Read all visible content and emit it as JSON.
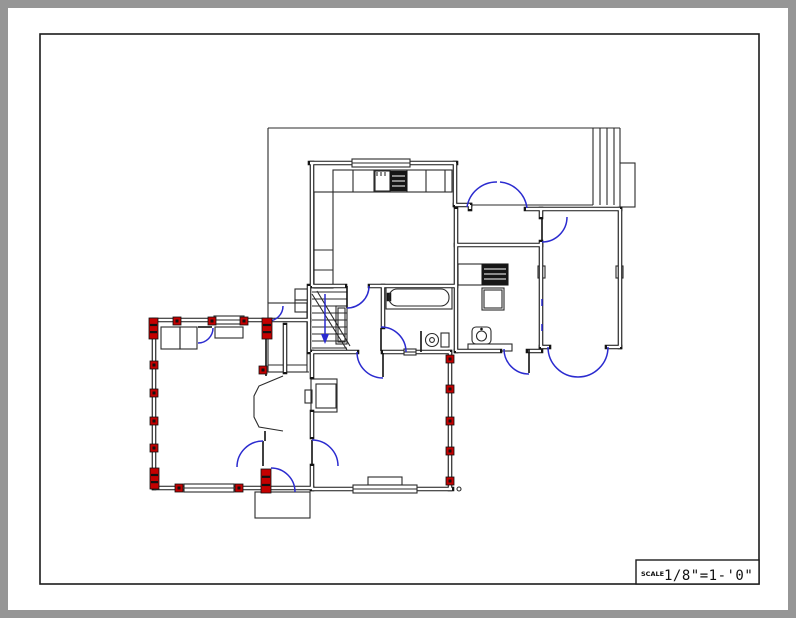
{
  "page": {
    "bg": "#969696",
    "paper": "#ffffff"
  },
  "colors": {
    "ink": "#2b2b2b",
    "blue": "#2b2bcf",
    "red": "#c40000",
    "wall": "#151515"
  },
  "scale_box": {
    "label": "SCALE",
    "value": "1/8\"=1-'0\""
  },
  "plan": {
    "thin_rects": [
      [
        268,
        303,
        39,
        69
      ],
      [
        255,
        492,
        55,
        26
      ],
      [
        620,
        163,
        15,
        44
      ],
      [
        333,
        170,
        119,
        22
      ],
      [
        314,
        192,
        19,
        96
      ],
      [
        374,
        171,
        16,
        20
      ],
      [
        458,
        264,
        50,
        21
      ],
      [
        482,
        288,
        22,
        22
      ],
      [
        484,
        290,
        18,
        18
      ],
      [
        386,
        286,
        66,
        23
      ],
      [
        441,
        333,
        8,
        14
      ],
      [
        468,
        344,
        44,
        7
      ],
      [
        311,
        379,
        26,
        33
      ],
      [
        316,
        384,
        20,
        24
      ],
      [
        305,
        390,
        7,
        13
      ],
      [
        336,
        306,
        11,
        38
      ],
      [
        338,
        308,
        7,
        34
      ],
      [
        161,
        327,
        19,
        22
      ],
      [
        180,
        327,
        17,
        22
      ],
      [
        215,
        327,
        28,
        11
      ],
      [
        295,
        289,
        13,
        11
      ],
      [
        295,
        300,
        13,
        12
      ],
      [
        368,
        477,
        34,
        8
      ],
      [
        538,
        266,
        7,
        12
      ],
      [
        616,
        266,
        7,
        12
      ]
    ],
    "thin_lines": [
      [
        268,
        128,
        620,
        128
      ],
      [
        268,
        128,
        268,
        303
      ],
      [
        458,
        205,
        593,
        205
      ],
      [
        593,
        128,
        593,
        205
      ],
      [
        600,
        128,
        600,
        205
      ],
      [
        607,
        128,
        607,
        205
      ],
      [
        614,
        128,
        614,
        205
      ],
      [
        620,
        128,
        620,
        163
      ],
      [
        268,
        365,
        307,
        365
      ],
      [
        285,
        372,
        309,
        372
      ],
      [
        353,
        170,
        353,
        192
      ],
      [
        375,
        170,
        375,
        192
      ],
      [
        407,
        170,
        407,
        192
      ],
      [
        426,
        170,
        426,
        192
      ],
      [
        445,
        170,
        445,
        192
      ],
      [
        314,
        250,
        333,
        250
      ],
      [
        314,
        270,
        333,
        270
      ],
      [
        482,
        264,
        482,
        285
      ],
      [
        312,
        292,
        347,
        292
      ],
      [
        312,
        299,
        347,
        299
      ],
      [
        312,
        306,
        347,
        306
      ],
      [
        312,
        313,
        347,
        313
      ],
      [
        312,
        320,
        347,
        320
      ],
      [
        312,
        327,
        347,
        327
      ],
      [
        312,
        334,
        347,
        334
      ],
      [
        312,
        341,
        347,
        341
      ],
      [
        312,
        348,
        347,
        348
      ],
      [
        312,
        294,
        347,
        350
      ],
      [
        317,
        291,
        350,
        346
      ],
      [
        377,
        172,
        377,
        176
      ],
      [
        381,
        172,
        381,
        176
      ],
      [
        385,
        172,
        385,
        176
      ]
    ],
    "hollow_walls": [
      [
        310,
        163,
        353,
        163
      ],
      [
        410,
        163,
        456,
        163
      ],
      [
        312,
        163,
        312,
        286
      ],
      [
        455,
        163,
        455,
        205
      ],
      [
        455,
        205,
        470,
        205
      ],
      [
        470,
        205,
        470,
        209
      ],
      [
        526,
        209,
        620,
        209
      ],
      [
        541,
        209,
        541,
        217
      ],
      [
        541,
        242,
        541,
        347
      ],
      [
        620,
        209,
        620,
        347
      ],
      [
        541,
        347,
        549,
        347
      ],
      [
        607,
        347,
        620,
        347
      ],
      [
        456,
        209,
        456,
        351
      ],
      [
        456,
        245,
        541,
        245
      ],
      [
        456,
        351,
        500,
        351
      ],
      [
        528,
        351,
        541,
        351
      ],
      [
        312,
        286,
        345,
        286
      ],
      [
        370,
        286,
        456,
        286
      ],
      [
        309,
        286,
        309,
        352
      ],
      [
        383,
        286,
        383,
        327
      ],
      [
        312,
        352,
        357,
        352
      ],
      [
        383,
        352,
        404,
        352
      ],
      [
        416,
        352,
        450,
        352
      ],
      [
        450,
        352,
        450,
        489
      ],
      [
        312,
        489,
        353,
        489
      ],
      [
        417,
        489,
        452,
        489
      ],
      [
        312,
        352,
        312,
        377
      ],
      [
        312,
        412,
        312,
        437
      ],
      [
        312,
        466,
        312,
        489
      ],
      [
        152,
        320,
        262,
        320
      ],
      [
        154,
        320,
        154,
        488
      ],
      [
        154,
        488,
        262,
        488
      ],
      [
        271,
        320,
        309,
        320
      ],
      [
        271,
        488,
        312,
        488
      ],
      [
        285,
        325,
        285,
        372
      ]
    ],
    "windows": [
      [
        352,
        159,
        58,
        8
      ],
      [
        353,
        485,
        64,
        8
      ],
      [
        214,
        316,
        30,
        8
      ],
      [
        184,
        484,
        50,
        8
      ],
      [
        404,
        349,
        12,
        6
      ]
    ],
    "dark_rects": [
      [
        390,
        171,
        17,
        20
      ],
      [
        482,
        264,
        26,
        21
      ],
      [
        387,
        293,
        4,
        8
      ]
    ],
    "white_lines": [
      [
        392,
        176,
        405,
        176
      ],
      [
        392,
        181,
        405,
        181
      ],
      [
        392,
        186,
        405,
        186
      ],
      [
        484,
        269,
        506,
        269
      ],
      [
        484,
        274,
        506,
        274
      ],
      [
        484,
        279,
        506,
        279
      ]
    ],
    "round_rects": [
      [
        389,
        289,
        60,
        17,
        8
      ],
      [
        472,
        327,
        19,
        17,
        4
      ]
    ],
    "circles": [
      [
        432,
        340,
        6.5
      ],
      [
        432,
        340,
        2.4
      ],
      [
        481.5,
        336,
        5
      ],
      [
        459,
        489,
        2
      ]
    ],
    "dots": [
      [
        481.5,
        329,
        1.3
      ]
    ],
    "leaf_lines": [
      [
        347,
        286,
        347,
        308
      ],
      [
        381,
        328,
        381,
        351
      ],
      [
        542,
        218,
        542,
        241
      ],
      [
        312,
        440,
        312,
        465
      ],
      [
        263,
        441,
        263,
        466
      ],
      [
        383,
        353,
        383,
        377
      ],
      [
        529,
        349,
        529,
        373
      ],
      [
        198,
        327,
        212,
        327
      ],
      [
        421,
        331,
        421,
        352
      ],
      [
        266,
        338,
        266,
        376
      ],
      [
        265,
        431,
        265,
        441
      ]
    ],
    "thin_paths": [
      "M 283,376 L 259,386 L 254,396 L 254,417 L 259,427 L 283,431"
    ],
    "blue_arcs": [
      "M 347,308 A 22 22 0 0 0 369,286",
      "M 467,207 A 30 30 0 0 1 497,182",
      "M 500,182 A 30 30 0 0 1 527,208",
      "M 542,242 A 25 25 0 0 0 567,217",
      "M 381,327 A 25 25 0 0 1 406,352",
      "M 357,352 A 26 26 0 0 0 383,378",
      "M 548,347 A 30 30 0 0 0 578,377",
      "M 578,377 A 30 30 0 0 0 608,347",
      "M 504,349 A 25 25 0 0 0 529,374",
      "M 312,440 A 26 26 0 0 1 338,466",
      "M 263,441 A 26 26 0 0 0 237,467",
      "M 271,468 A 24 24 0 0 1 295,492",
      "M 213,328 A 15 15 0 0 1 198,343",
      "M 283,306 A 15 15 0 0 1 268,321"
    ],
    "blue_lines": [
      [
        542,
        299,
        542,
        306
      ],
      [
        542,
        324,
        542,
        331
      ],
      [
        325,
        294,
        325,
        336
      ]
    ],
    "arrow_head": "M 321,334 L 325,344 L 329,334 Z",
    "red_squares": [
      [
        446,
        355
      ],
      [
        446,
        385
      ],
      [
        446,
        417
      ],
      [
        446,
        447
      ],
      [
        446,
        477
      ],
      [
        173,
        317
      ],
      [
        208,
        317
      ],
      [
        240,
        317
      ],
      [
        150,
        361
      ],
      [
        150,
        389
      ],
      [
        150,
        417
      ],
      [
        150,
        444
      ],
      [
        175,
        484
      ],
      [
        235,
        484
      ],
      [
        259,
        366
      ]
    ],
    "red_posts": [
      [
        149,
        318,
        9,
        21
      ],
      [
        262,
        318,
        10,
        21
      ],
      [
        150,
        468,
        9,
        21
      ],
      [
        261,
        469,
        10,
        24
      ]
    ]
  }
}
